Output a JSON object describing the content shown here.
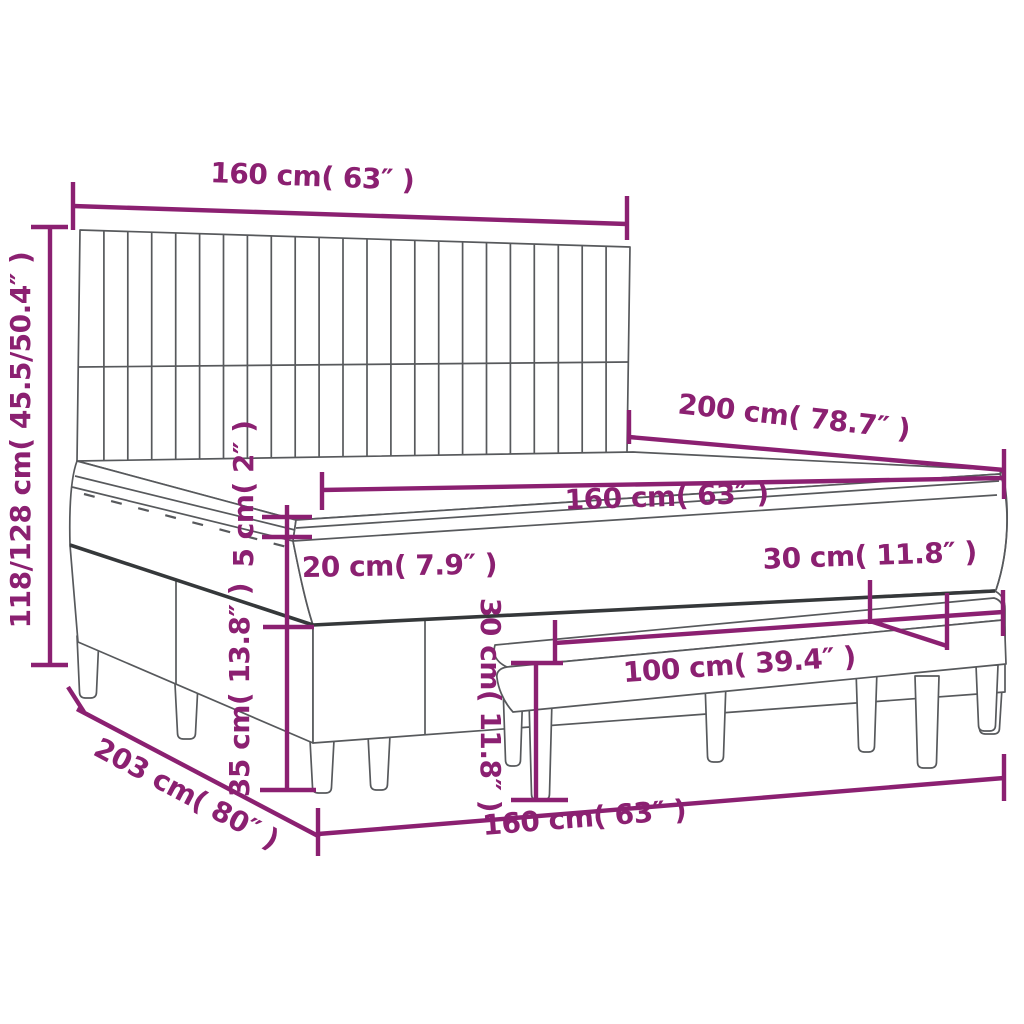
{
  "diagram": {
    "subject": "box-spring-bed-with-headboard-and-bench-dimension-diagram",
    "colors": {
      "accent": "#8B2071",
      "line": "#57595C",
      "dark_edge": "#35383A",
      "background": "#FFFFFF"
    },
    "dimensions": {
      "headboard_width": "160 cm( 63″ )",
      "headboard_height": "118/128 cm( 45.5/50.4″ )",
      "bed_length": "200 cm( 78.7″ )",
      "mattress_width": "160 cm( 63″ )",
      "topper_thickness": "5 cm( 2″ )",
      "mattress_thickness": "20 cm( 7.9″ )",
      "base_height": "35 cm( 13.8″ )",
      "bench_depth": "30 cm( 11.8″ )",
      "bench_height": "30 cm( 11.8″ )",
      "bench_length": "100 cm( 39.4″ )",
      "footprint_width": "160 cm( 63″ )",
      "footprint_length": "203 cm( 80″ )"
    }
  }
}
